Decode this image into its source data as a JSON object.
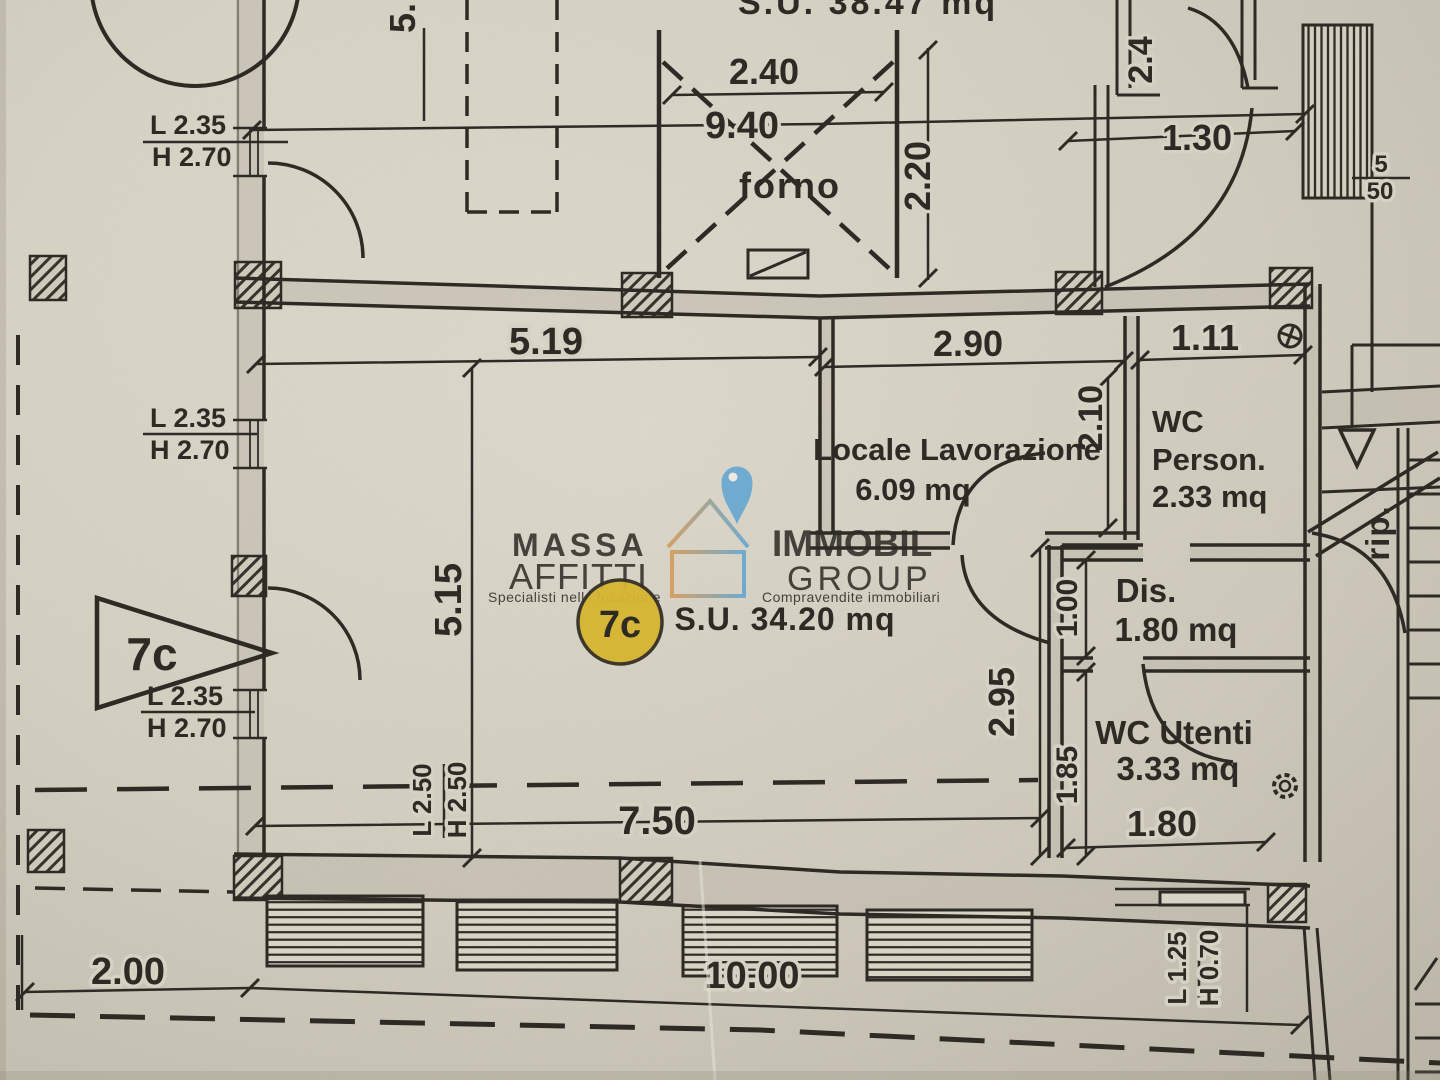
{
  "document": {
    "type": "scanned floor plan",
    "upper_unit": {
      "surface_label": "S.U. 38.47 mq"
    },
    "unit": {
      "id": "7c",
      "marker": "7c",
      "badge": "7c",
      "surface_label": "S.U. 34.20 mq"
    },
    "rooms": {
      "forno": {
        "name": "forno"
      },
      "locale_lavorazione": {
        "name": "Locale Lavorazione",
        "area": "6.09 mq"
      },
      "wc_person": {
        "name_line1": "WC",
        "name_line2": "Person.",
        "area": "2.33 mq"
      },
      "dis": {
        "name": "Dis.",
        "area": "1.80 mq"
      },
      "wc_utenti": {
        "name": "WC Utenti",
        "area": "3.33 mq"
      },
      "rip": {
        "name": "rip."
      }
    },
    "dimensions": {
      "top_width": "2.40",
      "overall_width": "9.40",
      "forno_height": "2.20",
      "top_right_door": "2.4",
      "top_right_corridor": "1.30",
      "top_left_partial": "5.",
      "main_width": "5.19",
      "locale_width": "2.90",
      "wc_person_width": "1.11",
      "locale_depth": "2.10",
      "main_depth": "5.15",
      "dis_depth": "1.00",
      "right_depth": "2.95",
      "wc_utenti_depth": "1.85",
      "wc_utenti_width": "1.80",
      "main_bottom_width": "7.50",
      "setback": "2.00",
      "overall_bottom_width": "10.00",
      "stair_fragment_top": "5",
      "stair_fragment_bottom": "50"
    },
    "window_labels": {
      "w235": {
        "l": "L 2.35",
        "h": "H 2.70"
      },
      "w250": {
        "l": "L 2.50",
        "h": "H 2.50"
      },
      "w125": {
        "l": "L 1.25",
        "h": "H 0.70"
      }
    }
  },
  "watermark": {
    "brand_top": "MASSA",
    "brand_bottom": "AFFITTI",
    "tagline_left": "Specialisti nella locazione",
    "brand_right_top": "IMMOBIL",
    "brand_right_bottom": "GROUP",
    "tagline_right": "Compravendite immobiliari",
    "colors": {
      "orange": "#e8925a",
      "blue": "#59a7d9",
      "white": "#f4f1ea"
    }
  },
  "colors": {
    "paper": "#dcd8ca",
    "ink": "#2b2823",
    "wall_fill": "#c2beb0",
    "badge_yellow": "#dcb92f"
  }
}
